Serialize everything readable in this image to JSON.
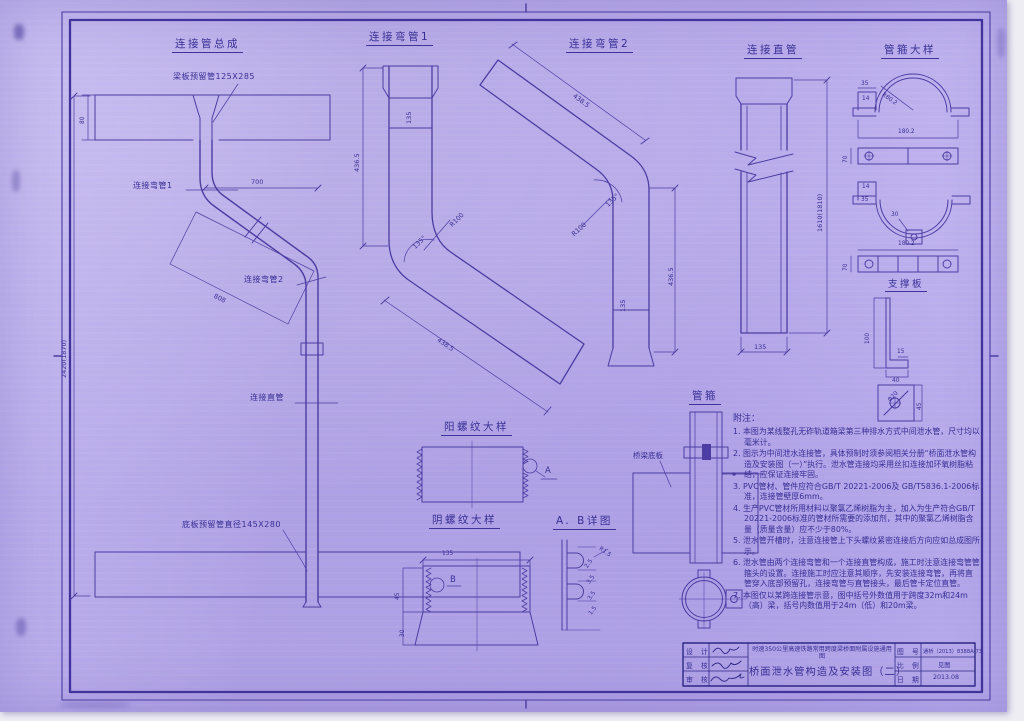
{
  "colors": {
    "paper": "#b4a7e8",
    "line": "#4b3da2",
    "ink": "#372e95"
  },
  "titles": {
    "assembly": "连接管总成",
    "bend1": "连接弯管1",
    "bend2": "连接弯管2",
    "straight": "连接直管",
    "clamp_detail": "管箍大样",
    "support_plate": "支撑板",
    "male_thread": "阳螺纹大样",
    "female_thread": "阴螺纹大样",
    "ab_detail": "A. B详图",
    "clamp": "管箍"
  },
  "assembly": {
    "label_top_pipe": "梁板预留管125X285",
    "label_bend1": "连接弯管1",
    "label_bend2": "连接弯管2",
    "label_straight": "连接直管",
    "label_bottom_pipe": "底板预留管直径145X280",
    "dim_top": "700",
    "dim_left": "2420(1870)",
    "dim_diag": "808",
    "dim_slab": "80"
  },
  "bend1": {
    "dim_height": "436.5",
    "dim_socket": "135",
    "dim_radius": "R100",
    "dim_angle": "135°",
    "dim_diag": "438.5"
  },
  "bend2": {
    "dim_diag": "438.5",
    "dim_angle": "135°",
    "dim_radius": "R100",
    "dim_height": "436.5",
    "dim_socket": "135"
  },
  "straight": {
    "dim_height": "1610(1810)",
    "dim_width": "135"
  },
  "clamp_detail": {
    "dim_tab_w": "35",
    "dim_tab_h": "14",
    "dim_radius": "R80.2",
    "dim_len": "180.2",
    "dim_bar": "70",
    "dim_tab_h2": "14",
    "dim_tab_w2": "35",
    "dim_notch": "30",
    "dim_len2": "180.2",
    "dim_bar2": "70"
  },
  "support_plate": {
    "dim_height": "100",
    "dim_foot": "15",
    "dim_width": "40",
    "dim_hole": "Φ20",
    "dim_side": "45"
  },
  "male_thread": {
    "callout": "A"
  },
  "female_thread": {
    "dim_width": "135",
    "callout": "B",
    "dim_thread": "45",
    "dim_socket": "30"
  },
  "ab_detail": {
    "dims": [
      "2.5",
      "3.5",
      "3.5",
      "1.5"
    ],
    "radius": "R1.5"
  },
  "clamp": {
    "label_slab": "桥梁底板"
  },
  "notes": {
    "title": "附注：",
    "items": [
      "1. 本图为某线整孔无砟轨道箱梁第三种排水方式中间泄水管，尺寸均以毫米计。",
      "2. 图示为中间泄水连接管，具体预制时须参阅相关分册“桥面泄水管构造及安装图（一）”执行。泄水管连接均采用丝扣连接加环氧树脂粘结，应保证连接牢固。",
      "3. PVC管材、管件应符合GB/T 20221-2006及 GB/T5836.1-2006标准，连接管壁厚6mm。",
      "4. 生产PVC管材所用材料以聚氯乙烯树脂为主，加入为生产符合GB/T 20221-2006标准的管材所需要的添加剂，其中的聚氯乙烯树脂含量（质量含量）应不少于80%。",
      "5. 泄水管开槽时，注意连接管上下头螺纹紧密连接后方向应如总成图所示。",
      "6. 泄水管由两个连接弯管和一个连接直管构成，施工时注意连接弯管管箍头的设置。连接施工时应注意其顺序，先安装连接弯管，再将直管穿入底部预留孔，连接弯管与直管接头，最后管卡定位直管。",
      "7. 本图仅以某跨连接管示意，图中括号外数值用于跨度32m和24m（高）梁，括号内数值用于24m（低）和20m梁。"
    ]
  },
  "titleblock": {
    "rows": [
      {
        "label": "设 计"
      },
      {
        "label": "复 核"
      },
      {
        "label": "审 核"
      }
    ],
    "project": "时速350公里高速铁路常用跨度梁桥面附属设施通用图",
    "drawing_title": "桥面泄水管构造及安装图（二）",
    "fields": [
      {
        "label": "图 号",
        "value": "通桥（2013）8388A-73"
      },
      {
        "label": "比 例",
        "value": "见图"
      },
      {
        "label": "日 期",
        "value": "2013.08"
      }
    ]
  }
}
